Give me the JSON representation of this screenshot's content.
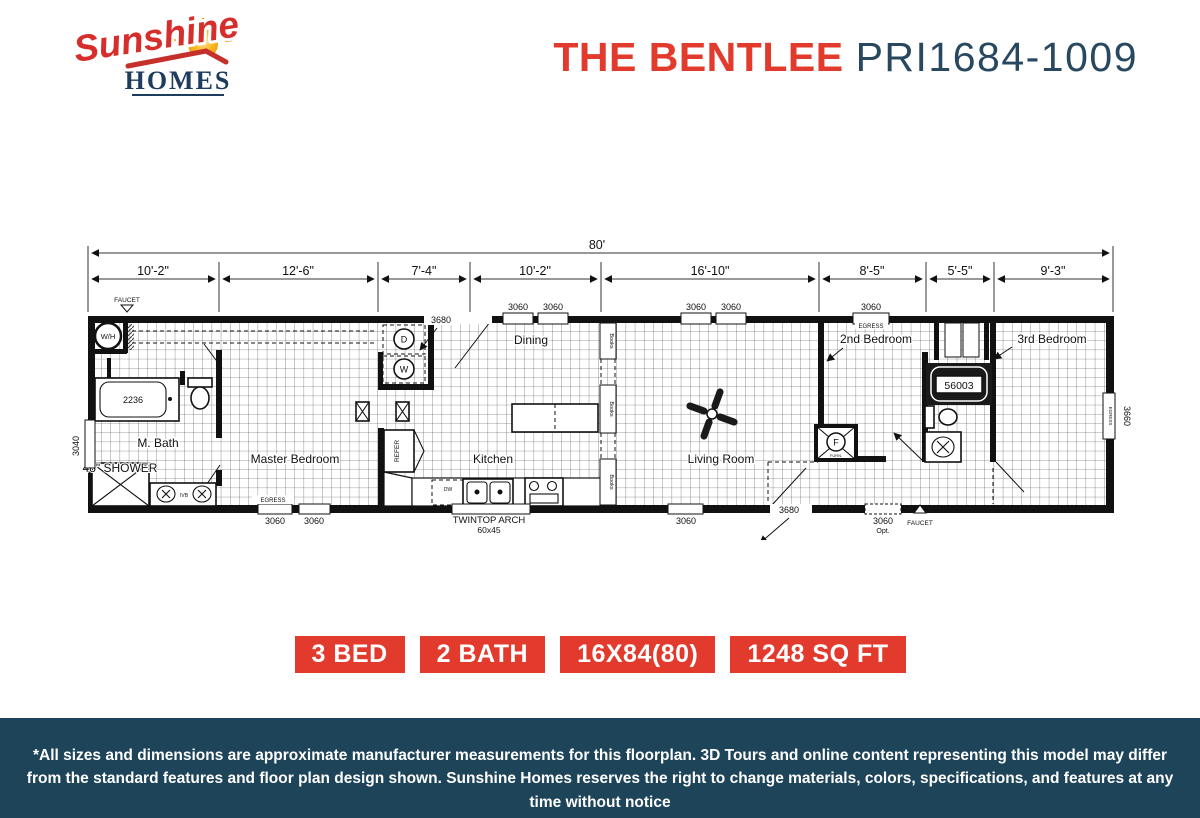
{
  "header": {
    "logo": {
      "line1": "Sunshine",
      "line2": "HOMES"
    },
    "title": {
      "name": "THE BENTLEE",
      "model": "PRI1684-1009"
    }
  },
  "badges": [
    "3 BED",
    "2 BATH",
    "16X84(80)",
    "1248 SQ FT"
  ],
  "plan": {
    "overall": "80'",
    "dims": [
      "10'-2\"",
      "12'-6\"",
      "7'-4\"",
      "10'-2\"",
      "16'-10\"",
      "8'-5\"",
      "5'-5\"",
      "9'-3\""
    ],
    "side_left": "3040",
    "side_right": "3660",
    "labels": {
      "w3060": "3060",
      "d3680": "3680",
      "opt": "Opt.",
      "egress": "EGRESS",
      "faucet": "FAUCET"
    },
    "rooms": {
      "mbath": "M. Bath",
      "master": "Master Bedroom",
      "dining": "Dining",
      "kitchen": "Kitchen",
      "living": "Living Room",
      "bed2": "2nd Bedroom",
      "bed3": "3rd Bedroom"
    },
    "fixtures": {
      "wh": "W/H",
      "dryer": "D",
      "washer": "W",
      "tub_master": "2236",
      "tub_second": "56003",
      "refer": "REFER",
      "dw": "DW",
      "ivb": "IVB",
      "shower": "48\" SHOWER",
      "arch": "TWINTOP ARCH",
      "arch_size": "60x45",
      "books": "Books",
      "furnace": "F",
      "furnace_sub": "FURN."
    }
  },
  "footer": {
    "disclaimer": "*All sizes and dimensions are approximate manufacturer measurements for this floorplan. 3D Tours and online content representing this model may differ from the standard features and floor plan design shown. Sunshine Homes reserves the right to change materials, colors, specifications, and features at any time without notice"
  }
}
